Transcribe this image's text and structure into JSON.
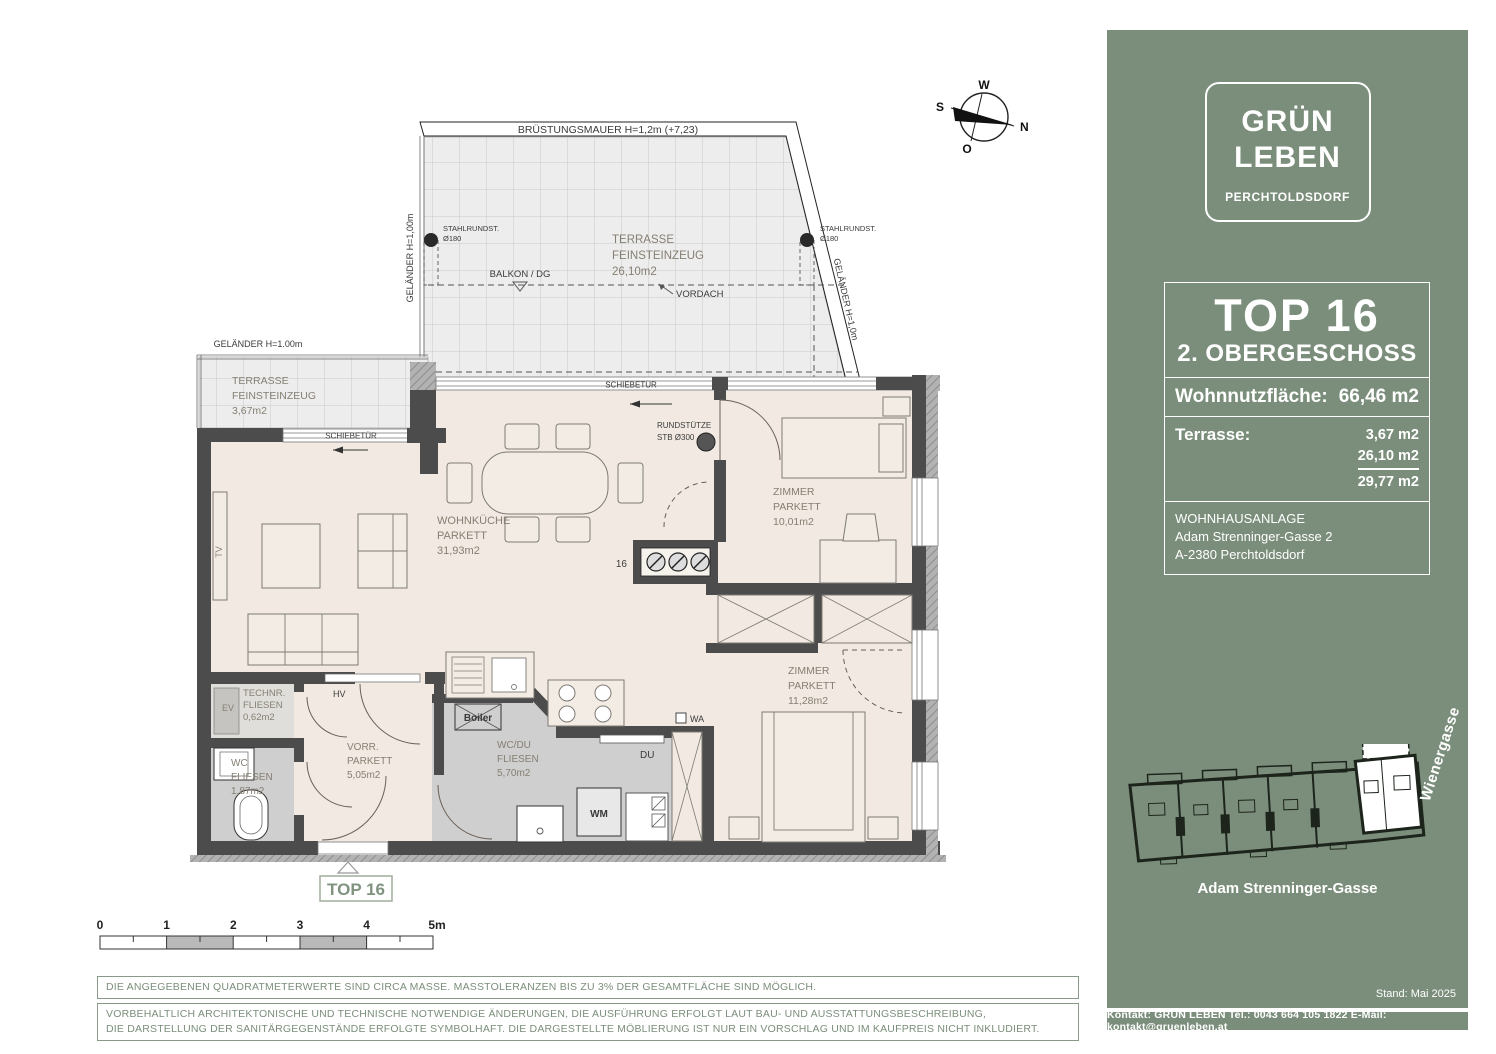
{
  "compass": {
    "n": "N",
    "o": "O",
    "s": "S",
    "w": "W"
  },
  "plan": {
    "top_terrace": {
      "wall": "BRÜSTUNGSMAUER H=1,2m  (+7,23)",
      "railing_left": "GELÄNDER H=1,00m",
      "railing_right": "GELÄNDER H=1,0m",
      "post_l1": "STAHLRUNDST.",
      "post_l2": "Ø180",
      "name": "TERRASSE",
      "material": "FEINSTEINZEUG",
      "area": "26,10m2",
      "balkon": "BALKON / DG",
      "vordach": "VORDACH"
    },
    "side_terrace": {
      "railing": "GELÄNDER H=1.00m",
      "name": "TERRASSE",
      "material": "FEINSTEINZEUG",
      "area": "3,67m2"
    },
    "labels": {
      "schiebetuer": "SCHIEBETÜR",
      "rundstuetze1": "RUNDSTÜTZE",
      "rundstuetze2": "STB Ø300",
      "shaft": "16",
      "hv": "HV",
      "wa": "WA",
      "du": "DU",
      "wm": "WM",
      "boiler": "Boiler",
      "tv": "TV",
      "ev": "EV"
    },
    "rooms": {
      "wohnkueche": {
        "name": "WOHNKÜCHE",
        "material": "PARKETT",
        "area": "31,93m2"
      },
      "zimmer1": {
        "name": "ZIMMER",
        "material": "PARKETT",
        "area": "10,01m2"
      },
      "zimmer2": {
        "name": "ZIMMER",
        "material": "PARKETT",
        "area": "11,28m2"
      },
      "vorraum": {
        "name": "VORR.",
        "material": "PARKETT",
        "area": "5,05m2"
      },
      "wcdu": {
        "name": "WC/DU",
        "material": "FLIESEN",
        "area": "5,70m2"
      },
      "wc": {
        "name": "WC",
        "material": "FLIESEN",
        "area": "1,87m2"
      },
      "technik": {
        "name": "TECHNR.",
        "material": "FLIESEN",
        "area": "0,62m2"
      }
    },
    "entry_marker": "TOP 16",
    "scalebar": {
      "t0": "0",
      "t1": "1",
      "t2": "2",
      "t3": "3",
      "t4": "4",
      "t5": "5m"
    }
  },
  "notes": {
    "line1": "DIE ANGEGEBENEN QUADRATMETERWERTE SIND CIRCA MASSE.   MASSTOLERANZEN BIS ZU 3% DER GESAMTFLÄCHE SIND MÖGLICH.",
    "line2a": "VORBEHALTLICH ARCHITEKTONISCHE UND TECHNISCHE NOTWENDIGE ÄNDERUNGEN, DIE AUSFÜHRUNG ERFOLGT LAUT BAU- UND AUSSTATTUNGSBESCHREIBUNG,",
    "line2b": "DIE DARSTELLUNG DER SANITÄRGEGENSTÄNDE ERFOLGTE SYMBOLHAFT. DIE DARGESTELLTE MÖBLIERUNG IST NUR EIN VORSCHLAG UND IM KAUFPREIS NICHT INKLUDIERT."
  },
  "sidebar": {
    "logo": {
      "line1": "GRÜN",
      "line2": "LEBEN",
      "line3": "PERCHTOLDSDORF"
    },
    "unit": {
      "title": "TOP 16",
      "floor": "2. OBERGESCHOSS"
    },
    "living_area": {
      "label": "Wohnnutzfläche:",
      "value": "66,46 m2"
    },
    "terrace": {
      "label": "Terrasse:",
      "values": [
        "3,67 m2",
        "26,10 m2",
        "29,77 m2"
      ]
    },
    "address": {
      "line1": "WOHNHAUSANLAGE",
      "line2": "Adam Strenninger-Gasse 2",
      "line3": "A-2380 Perchtoldsdorf"
    },
    "siteplan": {
      "street_right": "Wienergasse",
      "street_bottom": "Adam Strenninger-Gasse"
    },
    "stand": "Stand: Mai 2025",
    "footer": "Kontakt: GRÜN LEBEN Tel.: 0043 664 105 1822   E-Mail: kontakt@gruenleben.at",
    "colors": {
      "green": "#7b8e7b"
    }
  }
}
